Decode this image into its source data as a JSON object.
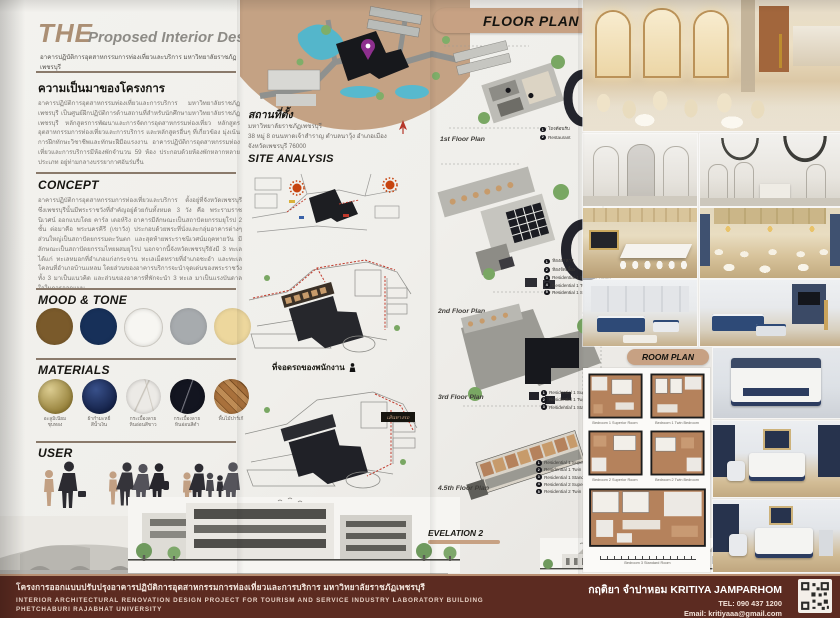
{
  "colors": {
    "accent": "#c7a183",
    "footer_bg": "#5c2b21",
    "map_circle": "#c4a284"
  },
  "title": {
    "the": "THE",
    "main": "Proposed Interior Design Project",
    "subtitle": "อาคารปฏิบัติการอุตสาหกรรมการท่องเที่ยวและบริการ มหาวิทยาลัยราชภัฏเพชรบุรี"
  },
  "background": {
    "heading": "ความเป็นมาของโครงการ",
    "body": "อาคารปฏิบัติการอุตสาหกรรมท่องเที่ยวและการบริการ มหาวิทยาลัยราชภัฏเพชรบุรี เป็นศูนย์ฝึกปฏิบัติการด้านสถานที่สำหรับนักศึกษามหาวิทยาลัยราชภัฏเพชรบุรี หลักสูตรการพัฒนาและการจัดการอุตสาหกรรมท่องเที่ยว หลักสูตรอุตสาหกรรมการท่องเที่ยวและการบริการ และหลักสูตรอื่นๆ ที่เกี่ยวข้อง มุ่งเน้นการฝึกทักษะวิชาชีพและทักษะฝีมือแรงงาน อาคารปฏิบัติการอุตสาหกรรมท่องเที่ยวและการบริการมีห้องพักจำนวน 59 ห้อง ประกอบด้วยห้องพักหลากหลายประเภท อยู่ท่ามกลางบรรยากาศอันร่มรื่น"
  },
  "concept": {
    "heading": "CONCEPT",
    "body": "อาคารปฏิบัติการอุตสาหกรรมการท่องเที่ยวและบริการ ตั้งอยู่ที่จังหวัดเพชรบุรี ซึ่งเพชรบุรีนั้นมีพระราชวังที่สำคัญอยู่ด้วยกันทั้งหมด 3 วัง คือ พระรามราชนิเวศน์ ออกแบบโดย คาร์ล เดอห์ริง อาคารมีลักษณะเป็นสถาปัตยกรรมยุโรป 2 ชั้น ต่อมาคือ พระนครคีรี (เขาวัง) ประกอบด้วยพระที่นั่งและกลุ่มอาคารต่างๆ ส่วนใหญ่เป็นสถาปัตยกรรมตะวันตก และสุดท้ายพระราชนิเวศน์มฤคทายวัน มีลักษณะเป็นสถาปัตยกรรมไทยผสมยุโรป นอกจากนี้จังหวัดเพชรบุรียังมี 3 ทะเล ได้แก่ ทะเลหมอกที่อำเภอแก่งกระจาน ทะเลเม็ดทรายที่อำเภอชะอำ และทะเลโคลนที่อำเภอบ้านแหลม โดยส่วนของอาคารบริการจะนำจุดเด่นของพระราชวังทั้ง 3 มาเป็นแนวคิด และส่วนของอาคารที่พักจะนำ 3 ทะเล มาเป็นแรงบันดาลใจในการออกแบบ"
  },
  "mood_tone": {
    "heading": "MOOD & TONE",
    "colors": [
      "#7a5a2b",
      "#173059",
      "#f7f6f2",
      "#a7abae",
      "#edd79d"
    ]
  },
  "materials": {
    "heading": "MATERIALS",
    "items": [
      {
        "label": "อะลูมิเนียม\nชุบทอง",
        "color": "#b09a4d"
      },
      {
        "label": "ผ้ากำมะหยี่\nสีน้ำเงิน",
        "color": "#1c2f5f"
      },
      {
        "label": "กระเบื้องลาย\nหินอ่อนสีขาว",
        "color": "#eceae6"
      },
      {
        "label": "กระเบื้องลาย\nหินอ่อนสีดำ",
        "color": "#131520"
      },
      {
        "label": "พื้นไม้ปาร์เก้",
        "color": "#a9713c"
      }
    ]
  },
  "user": {
    "heading": "USER",
    "groups": [
      "กลุ่มนักธุรกิจ",
      "กลุ่มนักท่องเที่ยว",
      "ครอบครัว"
    ]
  },
  "location": {
    "heading": "สถานที่ตั้ง",
    "address": "มหาวิทยาลัยราชภัฏเพชรบุรี\n38 หมู่ 8 ถนนหาดเจ้าสำราญ ตำบลนาวุ้ง อำเภอเมือง\nจังหวัดเพชรบุรี 76000"
  },
  "site": {
    "heading": "SITE ANALYSIS",
    "caption_staff": "ที่จอดรถของพนักงาน",
    "caption_customer": "ที่จอดรถของลูกค้า",
    "route_label": "เส้นทางรถ"
  },
  "floor_plan": {
    "banner": "FLOOR PLAN",
    "plans": [
      {
        "label": "1st Floor Plan",
        "legend": [
          "โถงต้อนรับ",
          "Restaurant"
        ]
      },
      {
        "label": "2nd Floor Plan",
        "legend": [
          "ห้องอาหาร",
          "ห้องจัดเลี้ยง",
          "Residential 1 Superior Room",
          "Residential 1 Twin Bedroom",
          "Residential 1 Standard Room"
        ]
      },
      {
        "label": "3rd Floor Plan",
        "legend": [
          "Residential 1 Superior Room",
          "Residential 1 Twin Bedroom",
          "Residential 1 Standard Room"
        ]
      },
      {
        "label": "4.5th Floor Plan",
        "legend": [
          "Residential 1 Superior Room",
          "Residential 1 Twin Bedroom",
          "Residential 1 Standard Room",
          "Residential 2 Superior Room",
          "Residential 2 Twin Bedroom"
        ]
      }
    ]
  },
  "room_plan": {
    "banner": "ROOM PLAN",
    "captions": [
      "Bedroom 1 Superior Room",
      "Bedroom 1 Twin Bedroom",
      "Bedroom 2 Superior Room",
      "Bedroom 2 Twin Bedroom",
      "Bedroom 3 Standard Room"
    ]
  },
  "elevations": {
    "e1": "EVELATION 1",
    "e2": "EVELATION 2"
  },
  "footer": {
    "title_th": "โครงการออกแบบปรับปรุงอาคารปฏิบัติการอุตสาหกรรมการท่องเที่ยวและการบริการ มหาวิทยาลัยราชภัฏเพชรบุรี",
    "title_en": "INTERIOR ARCHITECTURAL RENOVATION DESIGN PROJECT FOR TOURISM AND SERVICE INDUSTRY LABORATORY BUILDING",
    "university": "PHETCHABURI RAJABHAT UNIVERSITY",
    "author": "กฤติยา จำปาหอม KRITIYA JAMPARHOM",
    "tel": "TEL: 090 437 1200",
    "email": "Email: kritiyaaa@gmail.com"
  }
}
